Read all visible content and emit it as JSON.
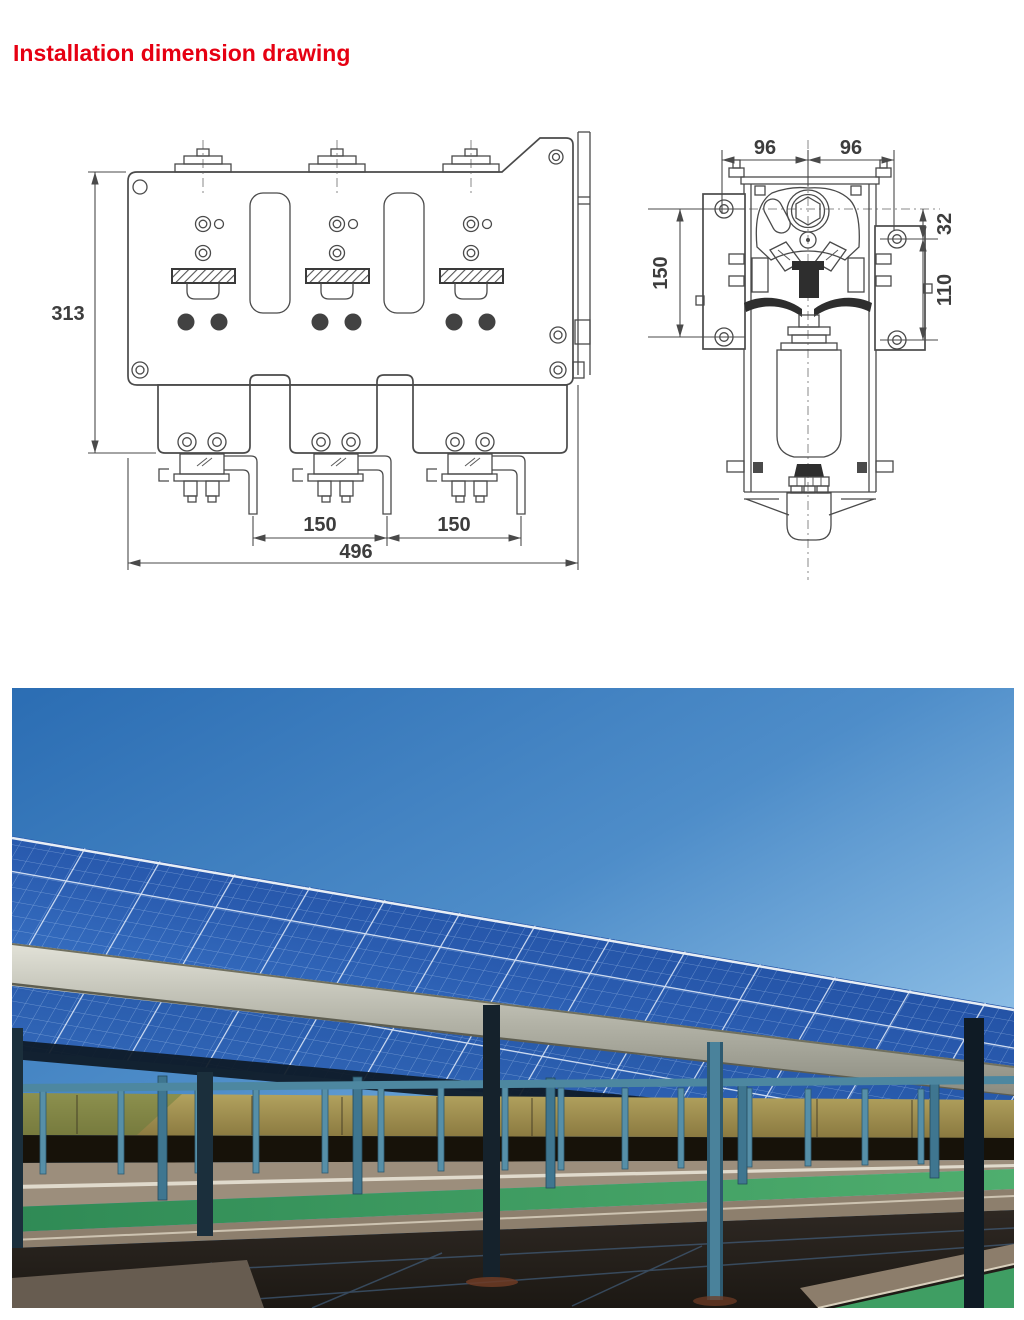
{
  "title": {
    "text": "Installation dimension drawing",
    "color": "#e60012"
  },
  "drawings": {
    "front_view": {
      "name": "front view of three-pole apparatus mounting plate",
      "dims": {
        "height": "313",
        "spacing_left": "150",
        "spacing_right": "150",
        "total_width": "496"
      }
    },
    "side_view": {
      "name": "side view of pole assembly",
      "dims": {
        "half_left": "96",
        "half_right": "96",
        "hole_spacing": "150",
        "offset_top": "32",
        "hole_spacing_right": "110"
      }
    }
  },
  "photo": {
    "description": "solar panel carport rows above a parking lot with green lane markings under a clear blue sky",
    "colors": {
      "sky": "#3f7fc1",
      "panels": "#2a5cb0",
      "beam": "#b9b9af",
      "field": "#a2904f",
      "green_lane": "#3f9e63",
      "asphalt_shadow": "#28231e"
    }
  }
}
